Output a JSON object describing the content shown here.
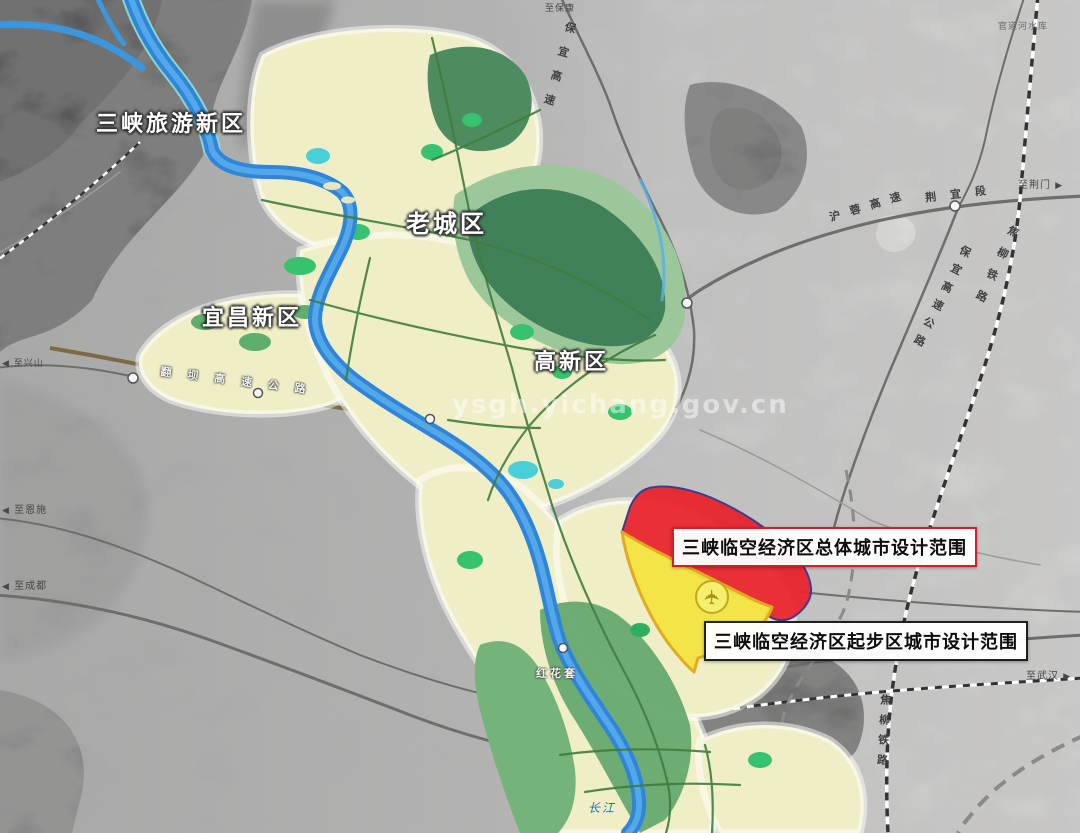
{
  "map": {
    "title": "宜昌三峡临空经济区城市设计范围示意图",
    "region_labels": {
      "tourism": "三峡旅游新区",
      "old_city": "老城区",
      "yichang_new": "宜昌新区",
      "hightech": "高新区"
    },
    "zone_callouts": {
      "overall": "三峡临空经济区总体城市设计范围",
      "starter": "三峡临空经济区起步区城市设计范围"
    },
    "edge_labels": {
      "to_jingmen": "至荆门",
      "to_xingshan": "至兴山",
      "to_enshi": "至恩施",
      "to_chengdu": "至成都",
      "to_wuhan": "至武汉",
      "to_baokang": "至保康"
    },
    "road_labels": {
      "hurong_expwy": "沪蓉高速",
      "jingyi_section": "荆宜段",
      "baoyi_north": "保宜高速",
      "baoyi_expwy": "保宜高速公路",
      "fanba_expwy": "翻坝高速公路"
    },
    "rail_labels": {
      "jiaoliu_right": "焦柳铁路",
      "jiaoliu_bottom": "焦柳铁路"
    },
    "place_labels": {
      "guandaohe_reservoir": "官道河水库",
      "honghuatao": "红花套",
      "yangtze": "长江"
    },
    "watermark": "ysgh.yichang.gov.cn",
    "icons": {
      "airport": "airport-icon"
    },
    "colors": {
      "overall_zone_fill": "#e8212b",
      "overall_zone_border": "#3c3c90",
      "starter_zone_fill": "#f2e343",
      "starter_zone_border": "#e2aa1f",
      "river": "#2f86d8",
      "urban_fill": "#efeec6",
      "forest": "#41815a",
      "terrain_dark": "#474747",
      "callout_overall_border": "#cf2127",
      "callout_starter_border": "#1f1f1f"
    }
  }
}
